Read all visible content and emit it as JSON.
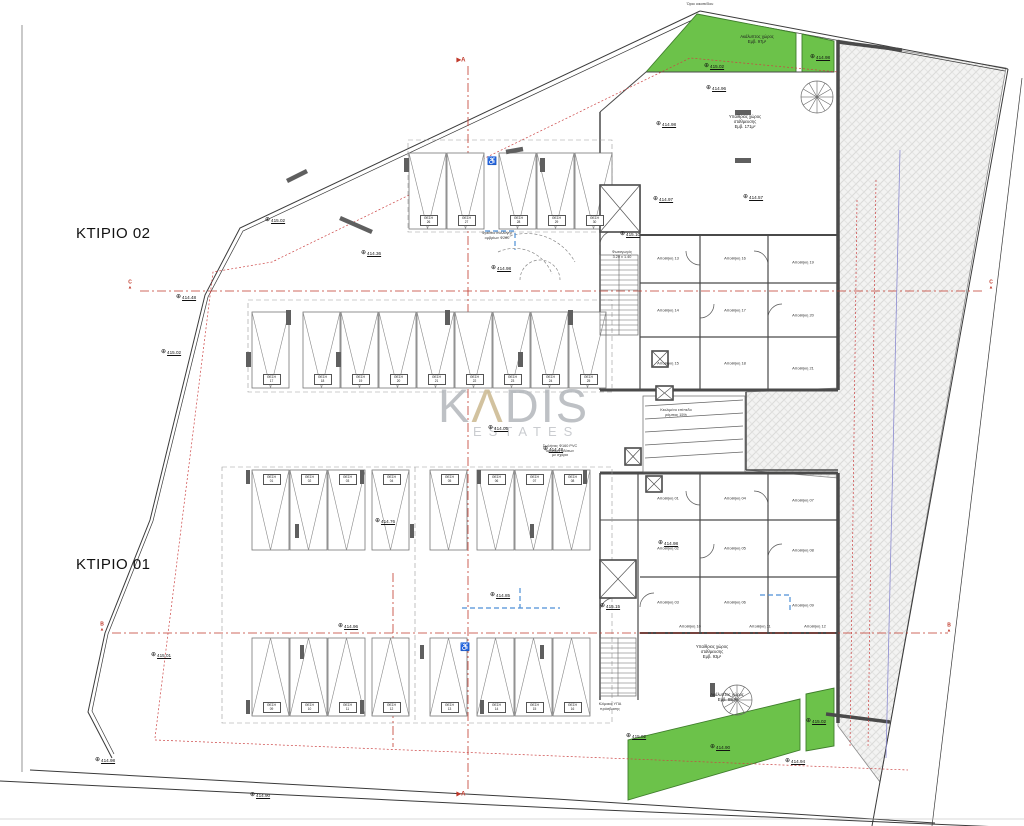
{
  "titles": {
    "building_02": "ΚΤΙΡΙΟ 02",
    "building_01": "ΚΤΙΡΙΟ 01"
  },
  "watermark": {
    "line1_prefix": "K",
    "line1_a": "Λ",
    "line1_suffix": "DIS",
    "line2": "ESTATES"
  },
  "colors": {
    "green": "#6cc24a",
    "green_edge": "#3f7d2c",
    "wall": "#4a4a4a",
    "red": "#c0392b",
    "red_dot": "#cc4444",
    "blue": "#4d8fd6",
    "violet": "#8a8ad0",
    "watermark_gray": "#aeb2b7",
    "watermark_gold": "#c8b488"
  },
  "section_markers": [
    {
      "label": "A",
      "x": 461,
      "y": 60,
      "style": "flag"
    },
    {
      "label": "A",
      "x": 461,
      "y": 794,
      "style": "flag"
    },
    {
      "label": "C",
      "x": 130,
      "y": 290,
      "style": "point"
    },
    {
      "label": "C",
      "x": 991,
      "y": 290,
      "style": "point"
    },
    {
      "label": "B",
      "x": 102,
      "y": 632,
      "style": "point"
    },
    {
      "label": "B",
      "x": 949,
      "y": 633,
      "style": "point"
    }
  ],
  "elevation_markers": [
    {
      "x": 267,
      "y": 220,
      "v": "415.02"
    },
    {
      "x": 178,
      "y": 297,
      "v": "414.48"
    },
    {
      "x": 163,
      "y": 352,
      "v": "415.02"
    },
    {
      "x": 363,
      "y": 253,
      "v": "414.36"
    },
    {
      "x": 493,
      "y": 268,
      "v": "414.98"
    },
    {
      "x": 706,
      "y": 66,
      "v": "415.02"
    },
    {
      "x": 708,
      "y": 88,
      "v": "414.96"
    },
    {
      "x": 812,
      "y": 57,
      "v": "414.98"
    },
    {
      "x": 655,
      "y": 199,
      "v": "414.97"
    },
    {
      "x": 745,
      "y": 197,
      "v": "414.57"
    },
    {
      "x": 490,
      "y": 428,
      "v": "414.05"
    },
    {
      "x": 545,
      "y": 449,
      "v": "414.48"
    },
    {
      "x": 377,
      "y": 521,
      "v": "414.76"
    },
    {
      "x": 340,
      "y": 626,
      "v": "414.96"
    },
    {
      "x": 492,
      "y": 595,
      "v": "414.85"
    },
    {
      "x": 660,
      "y": 543,
      "v": "414.98"
    },
    {
      "x": 622,
      "y": 234,
      "v": "415.10"
    },
    {
      "x": 602,
      "y": 606,
      "v": "415.15"
    },
    {
      "x": 628,
      "y": 736,
      "v": "415.02"
    },
    {
      "x": 808,
      "y": 721,
      "v": "415.02"
    },
    {
      "x": 712,
      "y": 747,
      "v": "414.90"
    },
    {
      "x": 787,
      "y": 761,
      "v": "414.94"
    },
    {
      "x": 97,
      "y": 760,
      "v": "414.98"
    },
    {
      "x": 153,
      "y": 655,
      "v": "415.01"
    },
    {
      "x": 252,
      "y": 795,
      "v": "414.90"
    },
    {
      "x": 658,
      "y": 124,
      "v": "414.98"
    }
  ],
  "parking": {
    "stall_label_prefix": "ΘΕΣΗ",
    "rows": [
      {
        "y": 153,
        "h": 76,
        "w": 37,
        "apex": "bottom",
        "label_side": "bottom",
        "stalls": [
          {
            "x": 409,
            "n": "26"
          },
          {
            "x": 447,
            "n": "27"
          },
          {
            "x": 499,
            "n": "28"
          },
          {
            "x": 537,
            "n": "29"
          },
          {
            "x": 575,
            "n": "30"
          }
        ]
      },
      {
        "y": 312,
        "h": 76,
        "w": 37,
        "apex": "bottom",
        "label_side": "bottom",
        "stalls": [
          {
            "x": 252,
            "n": "17"
          },
          {
            "x": 303,
            "n": "18"
          },
          {
            "x": 341,
            "n": "19"
          },
          {
            "x": 379,
            "n": "20"
          },
          {
            "x": 417,
            "n": "21"
          },
          {
            "x": 455,
            "n": "22"
          },
          {
            "x": 493,
            "n": "23"
          },
          {
            "x": 531,
            "n": "24"
          },
          {
            "x": 569,
            "n": "25"
          }
        ]
      },
      {
        "y": 470,
        "h": 80,
        "w": 37,
        "apex": "bottom",
        "label_side": "top",
        "stalls": [
          {
            "x": 252,
            "n": "01"
          },
          {
            "x": 290,
            "n": "02"
          },
          {
            "x": 328,
            "n": "03"
          },
          {
            "x": 372,
            "n": "04"
          },
          {
            "x": 430,
            "n": "05"
          },
          {
            "x": 477,
            "n": "06"
          },
          {
            "x": 515,
            "n": "07"
          },
          {
            "x": 553,
            "n": "08"
          }
        ]
      },
      {
        "y": 638,
        "h": 78,
        "w": 37,
        "apex": "top",
        "label_side": "bottom",
        "stalls": [
          {
            "x": 252,
            "n": "09"
          },
          {
            "x": 290,
            "n": "10"
          },
          {
            "x": 328,
            "n": "11"
          },
          {
            "x": 372,
            "n": "12"
          },
          {
            "x": 430,
            "n": "13"
          },
          {
            "x": 477,
            "n": "14"
          },
          {
            "x": 515,
            "n": "15"
          },
          {
            "x": 553,
            "n": "16"
          }
        ]
      }
    ]
  },
  "storage_label_prefix": "Αποθήκη",
  "storage_rooms": {
    "upper": [
      {
        "x": 668,
        "y": 258,
        "n": "13"
      },
      {
        "x": 668,
        "y": 310,
        "n": "14"
      },
      {
        "x": 668,
        "y": 363,
        "n": "15"
      },
      {
        "x": 735,
        "y": 258,
        "n": "16"
      },
      {
        "x": 735,
        "y": 310,
        "n": "17"
      },
      {
        "x": 735,
        "y": 363,
        "n": "18"
      },
      {
        "x": 803,
        "y": 262,
        "n": "19"
      },
      {
        "x": 803,
        "y": 315,
        "n": "20"
      },
      {
        "x": 803,
        "y": 368,
        "n": "21"
      }
    ],
    "lower": [
      {
        "x": 668,
        "y": 498,
        "n": "01"
      },
      {
        "x": 668,
        "y": 548,
        "n": "02"
      },
      {
        "x": 668,
        "y": 602,
        "n": "03"
      },
      {
        "x": 735,
        "y": 498,
        "n": "04"
      },
      {
        "x": 735,
        "y": 548,
        "n": "05"
      },
      {
        "x": 735,
        "y": 602,
        "n": "06"
      },
      {
        "x": 803,
        "y": 500,
        "n": "07"
      },
      {
        "x": 803,
        "y": 550,
        "n": "08"
      },
      {
        "x": 803,
        "y": 605,
        "n": "09"
      },
      {
        "x": 690,
        "y": 626,
        "n": "10"
      },
      {
        "x": 760,
        "y": 626,
        "n": "11"
      },
      {
        "x": 815,
        "y": 626,
        "n": "12"
      }
    ]
  },
  "area_labels": [
    {
      "x": 757,
      "y": 34,
      "lines": [
        "Ακάλυπτος χώρος",
        "Εμβ. 97μ²"
      ]
    },
    {
      "x": 745,
      "y": 114,
      "lines": [
        "Υπαίθριος χώρος",
        "στάθμευσης",
        "Εμβ. 171μ²"
      ]
    },
    {
      "x": 712,
      "y": 644,
      "lines": [
        "Υπαίθριος χώρος",
        "στάθμευσης",
        "Εμβ. 93μ²"
      ]
    },
    {
      "x": 727,
      "y": 692,
      "lines": [
        "Ακάλυπτος χώρος",
        "Εμβ. 88μ²"
      ]
    }
  ],
  "annotations": [
    {
      "x": 497,
      "y": 231,
      "lines": [
        "Φρεάτιο συλλογής",
        "ομβρίων Φ200"
      ]
    },
    {
      "x": 560,
      "y": 444,
      "lines": [
        "Σωλήνας Φ160 PVC",
        "ομβρίων υδάτων",
        "με σχάρα"
      ]
    },
    {
      "x": 610,
      "y": 702,
      "lines": [
        "Κλίμακα ΥΠΑ",
        "πρόσβασης"
      ]
    },
    {
      "x": 676,
      "y": 408,
      "lines": [
        "Κεκλιμένο επίπεδο",
        "ράμπας 15%"
      ]
    },
    {
      "x": 622,
      "y": 250,
      "lines": [
        "Φωταγωγός",
        "3.20 x 1.40"
      ]
    },
    {
      "x": 700,
      "y": 2,
      "lines": [
        "Όριο οικοπέδου"
      ]
    }
  ],
  "accessible_icons": [
    {
      "x": 492,
      "y": 161
    },
    {
      "x": 465,
      "y": 647
    }
  ]
}
